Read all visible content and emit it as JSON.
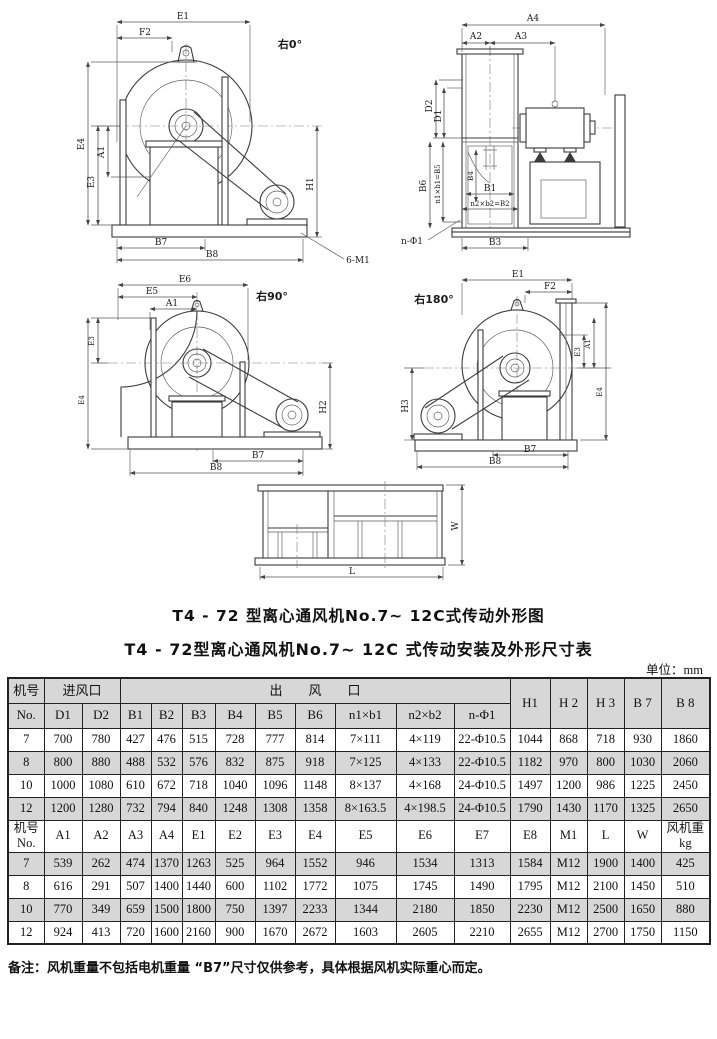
{
  "titles": {
    "outline_drawing": "T4 - 72 型离心通风机No.7~ 12C式传动外形图",
    "dimension_table": "T4 - 72型离心通风机No.7~ 12C 式传动安装及外形尺寸表",
    "unit": "单位：mm"
  },
  "note": "备注：风机重量不包括电机重量 “B7”尺寸仅供参考，具体根据风机实际重心而定。",
  "drawings": {
    "v0": {
      "angle": "右0°",
      "e1": "E1",
      "f2": "F2",
      "e4": "E4",
      "a1": "A1",
      "e3": "E3",
      "h1": "H1",
      "b7": "B7",
      "b8": "B8",
      "bolt": "6-M1"
    },
    "vfront": {
      "a4": "A4",
      "a2": "A2",
      "a3": "A3",
      "d2": "D2",
      "d1": "D1",
      "b6": "B6",
      "n1b1b5": "n1×b1=B5",
      "b4": "B4",
      "b1": "B1",
      "n2b2b2": "n2×b2=B2",
      "nphi1": "n-Φ1",
      "b3": "B3"
    },
    "v90": {
      "angle": "右90°",
      "e6": "E6",
      "e5": "E5",
      "a1": "A1",
      "e3": "E3",
      "e4": "E4",
      "h2": "H2",
      "b7": "B7",
      "b8": "B8"
    },
    "v180": {
      "angle": "右180°",
      "e1": "E1",
      "f2": "F2",
      "h3": "H3",
      "e3": "E3",
      "a1": "A1",
      "e4": "E4",
      "b7": "B7",
      "b8": "B8"
    },
    "base": {
      "l": "L",
      "w": "W"
    }
  },
  "table": {
    "section1": {
      "corner": "机号",
      "corner_sub": "No.",
      "inlet_header": "进风口",
      "outlet_header": "出　　风　　口",
      "right_headers": [
        "H1",
        "H 2",
        "H 3",
        "B 7",
        "B 8"
      ],
      "sub_headers": [
        "D1",
        "D2",
        "B1",
        "B2",
        "B3",
        "B4",
        "B5",
        "B6",
        "n1×b1",
        "n2×b2",
        "n-Φ1"
      ],
      "rows": [
        [
          "7",
          "700",
          "780",
          "427",
          "476",
          "515",
          "728",
          "777",
          "814",
          "7×111",
          "4×119",
          "22-Φ10.5",
          "1044",
          "868",
          "718",
          "930",
          "1860"
        ],
        [
          "8",
          "800",
          "880",
          "488",
          "532",
          "576",
          "832",
          "875",
          "918",
          "7×125",
          "4×133",
          "22-Φ10.5",
          "1182",
          "970",
          "800",
          "1030",
          "2060"
        ],
        [
          "10",
          "1000",
          "1080",
          "610",
          "672",
          "718",
          "1040",
          "1096",
          "1148",
          "8×137",
          "4×168",
          "24-Φ10.5",
          "1497",
          "1200",
          "986",
          "1225",
          "2450"
        ],
        [
          "12",
          "1200",
          "1280",
          "732",
          "794",
          "840",
          "1248",
          "1308",
          "1358",
          "8×163.5",
          "4×198.5",
          "24-Φ10.5",
          "1790",
          "1430",
          "1170",
          "1325",
          "2650"
        ]
      ]
    },
    "section2": {
      "header": [
        [
          "机号",
          "No."
        ],
        [
          "A1"
        ],
        [
          "A2"
        ],
        [
          "A3"
        ],
        [
          "A4"
        ],
        [
          "E1"
        ],
        [
          "E2"
        ],
        [
          "E3"
        ],
        [
          "E4"
        ],
        [
          "E5"
        ],
        [
          "E6"
        ],
        [
          "E7"
        ],
        [
          "E8"
        ],
        [
          "M1"
        ],
        [
          "L"
        ],
        [
          "W"
        ],
        [
          "风机重",
          "kg"
        ]
      ],
      "rows": [
        [
          "7",
          "539",
          "262",
          "474",
          "1370",
          "1263",
          "525",
          "964",
          "1552",
          "946",
          "1534",
          "1313",
          "1584",
          "M12",
          "1900",
          "1400",
          "425"
        ],
        [
          "8",
          "616",
          "291",
          "507",
          "1400",
          "1440",
          "600",
          "1102",
          "1772",
          "1075",
          "1745",
          "1490",
          "1795",
          "M12",
          "2100",
          "1450",
          "510"
        ],
        [
          "10",
          "770",
          "349",
          "659",
          "1500",
          "1800",
          "750",
          "1397",
          "2233",
          "1344",
          "2180",
          "1850",
          "2230",
          "M12",
          "2500",
          "1650",
          "880"
        ],
        [
          "12",
          "924",
          "413",
          "720",
          "1600",
          "2160",
          "900",
          "1670",
          "2672",
          "1603",
          "2605",
          "2210",
          "2655",
          "M12",
          "2700",
          "1750",
          "1150"
        ]
      ]
    }
  },
  "colors": {
    "row_shade": "#d7d7d7",
    "line": "#3b3b3b",
    "text": "#111111"
  }
}
